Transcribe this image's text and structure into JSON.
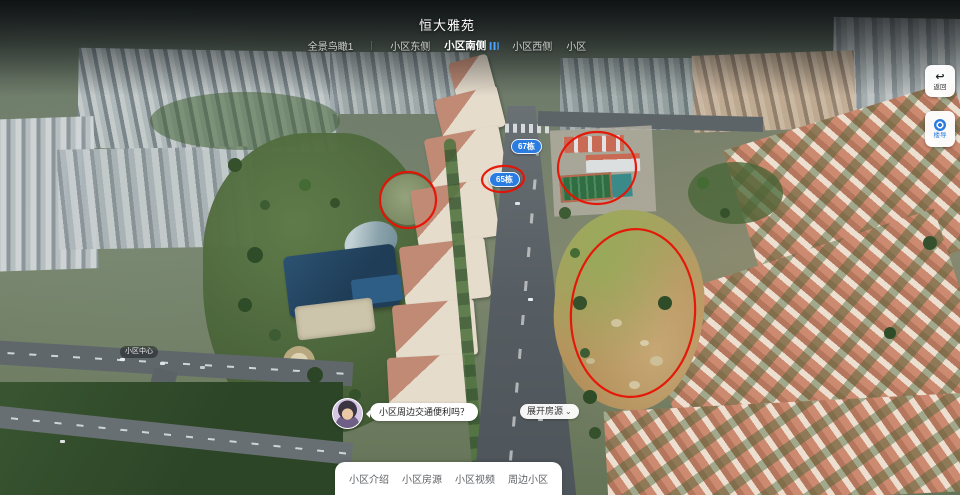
{
  "page": {
    "title": "恒大雅苑"
  },
  "scene_tabs": {
    "separator": "｜",
    "items": [
      {
        "label": "全景鸟瞰1",
        "active": false
      },
      {
        "label": "小区东侧",
        "active": false
      },
      {
        "label": "小区南侧",
        "active": true
      },
      {
        "label": "小区西侧",
        "active": false
      },
      {
        "label": "小区",
        "active": false
      }
    ]
  },
  "side_buttons": {
    "back": {
      "label": "返回",
      "icon": "↩"
    },
    "guide": {
      "label": "楼导"
    }
  },
  "building_labels": {
    "b67": "67栋",
    "b65": "65栋"
  },
  "map_label": {
    "community_center": "小区中心"
  },
  "chat": {
    "question": "小区周边交通便利吗？"
  },
  "listings_toggle": {
    "label": "展开房源",
    "chevron": "⌄"
  },
  "bottom_nav": {
    "items": [
      {
        "label": "小区介绍"
      },
      {
        "label": "小区房源"
      },
      {
        "label": "小区视频"
      },
      {
        "label": "周边小区"
      }
    ]
  },
  "colors": {
    "accent_blue": "#2b7ce0",
    "annotation_red": "#e81102"
  }
}
